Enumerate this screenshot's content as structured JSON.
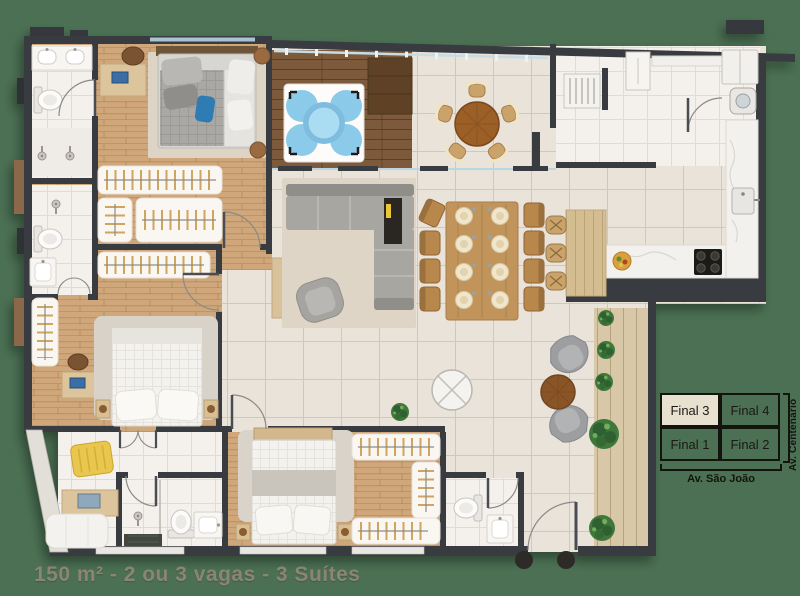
{
  "background_color": "#4b7053",
  "caption": {
    "text": "150 m² - 2 ou 3 vagas - 3 Suítes",
    "color": "#8c8474"
  },
  "legend": {
    "grid": [
      {
        "label": "Final 3",
        "highlighted": true
      },
      {
        "label": "Final 4",
        "highlighted": false
      },
      {
        "label": "Final 1",
        "highlighted": false
      },
      {
        "label": "Final 2",
        "highlighted": false
      }
    ],
    "street_bottom": "Av. São João",
    "street_right": "Av. Centenário",
    "highlight_color": "#e9e1d0",
    "border_color": "#14140e"
  },
  "plan_colors": {
    "wall": "#383b40",
    "wood_floor": "#cfa77a",
    "tile_floor": "#eae3da",
    "bath_floor": "#f4f1ec",
    "deck_dark": "#7c5a3b",
    "deck_light": "#d9c8a7",
    "water": "#8cc8e9",
    "plant": "#41773c",
    "sofa_gray": "#a7a6a1",
    "accent_yellow": "#e9c64d",
    "accent_blue_pillow": "#2f7cb3"
  }
}
